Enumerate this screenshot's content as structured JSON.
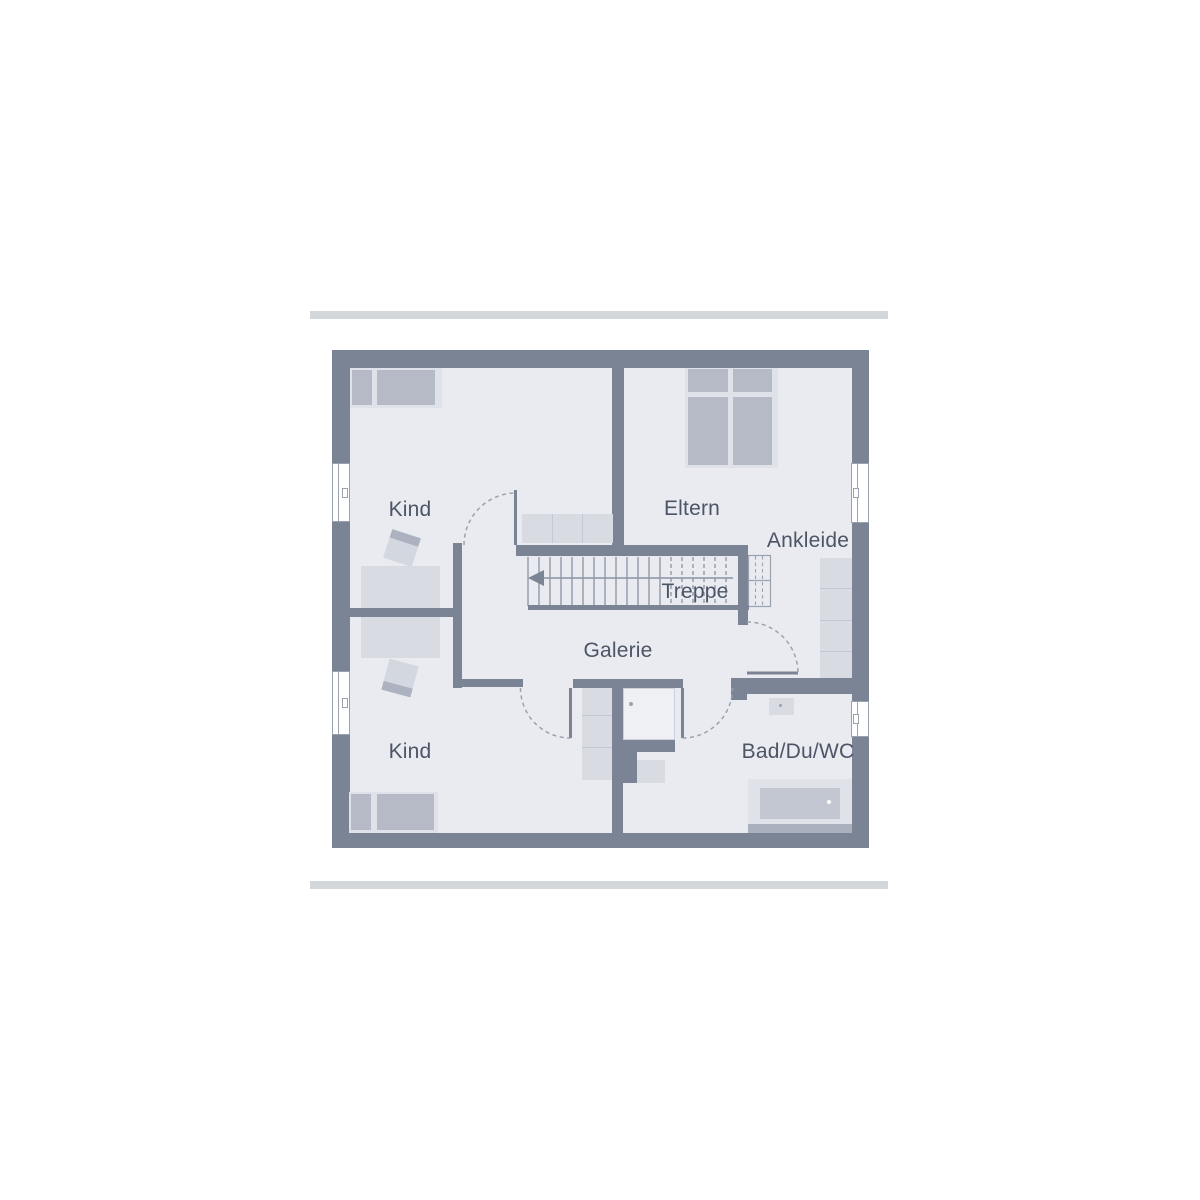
{
  "plan": {
    "title": "upper-floor-plan",
    "colors": {
      "wall": "#7b8495",
      "floor": "#e9ebf0",
      "line": "#9aa2ae",
      "tread": "#8a93a2",
      "furn-base": "#dfe2e9",
      "furn-dark": "#b5bac6",
      "furn-light": "#d8dbe2",
      "divider": "#c3c8d2",
      "tub-inner": "#c3c7d1",
      "text": "#4c5565",
      "bar": "#d3d6db"
    },
    "rooms": [
      {
        "id": "kind-top",
        "label": "Kind"
      },
      {
        "id": "eltern",
        "label": "Eltern"
      },
      {
        "id": "ankleide",
        "label": "Ankleide"
      },
      {
        "id": "treppe",
        "label": "Treppe"
      },
      {
        "id": "galerie",
        "label": "Galerie"
      },
      {
        "id": "kind-bottom",
        "label": "Kind"
      },
      {
        "id": "bad",
        "label": "Bad/Du/WC"
      }
    ],
    "furniture": [
      "bed",
      "desk",
      "chair",
      "dresser",
      "double-bed",
      "wardrobe",
      "shelf",
      "shower",
      "wc",
      "sink",
      "bathtub",
      "stairs",
      "doors",
      "windows"
    ]
  }
}
